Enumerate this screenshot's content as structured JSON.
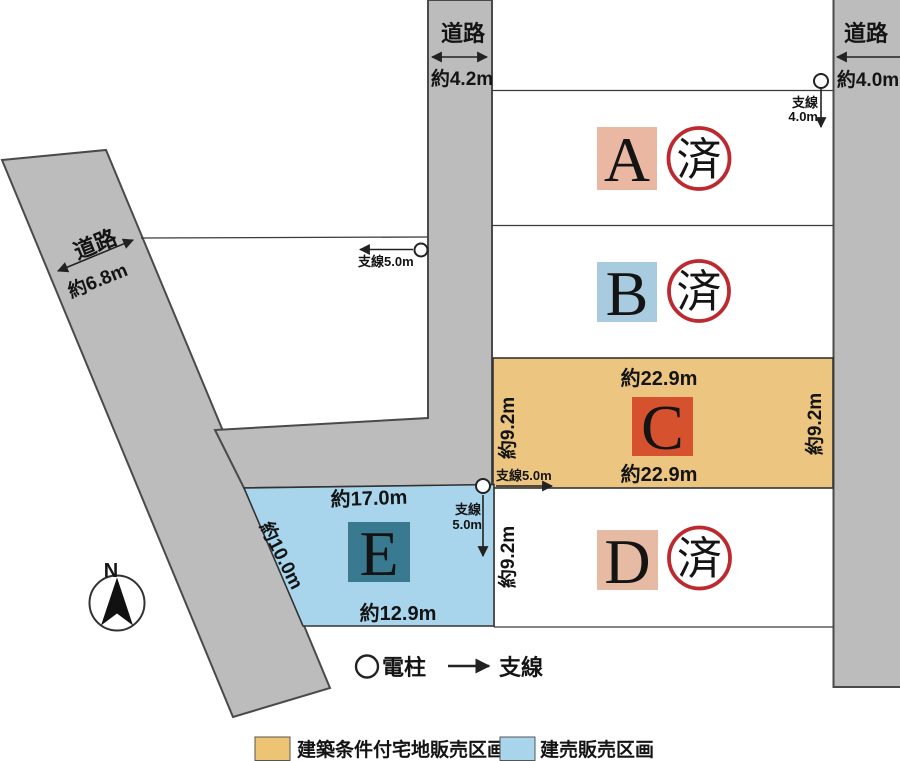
{
  "roads": {
    "top": {
      "name": "道路",
      "width": "約4.2m"
    },
    "right": {
      "name": "道路",
      "width": "約4.0m"
    },
    "left": {
      "name": "道路",
      "width": "約6.8m"
    }
  },
  "plots": {
    "a": {
      "id": "A",
      "stamp": "済"
    },
    "b": {
      "id": "B",
      "stamp": "済"
    },
    "c": {
      "id": "C",
      "top": "約22.9m",
      "bottom": "約22.9m",
      "left": "約9.2m",
      "right": "約9.2m"
    },
    "d": {
      "id": "D",
      "stamp": "済",
      "left": "約9.2m"
    },
    "e": {
      "id": "E",
      "top": "約17.0m",
      "bottom": "約12.9m",
      "left": "約10.0m"
    }
  },
  "wires": {
    "left_pole": {
      "label": "支線5.0m"
    },
    "right_pole": {
      "line1": "支線",
      "line2": "4.0m"
    },
    "c_wire": {
      "label": "支線5.0m"
    },
    "e_pole": {
      "line1": "支線",
      "line2": "5.0m"
    }
  },
  "compass": {
    "north": "N"
  },
  "symbols": {
    "pole": "電柱",
    "wire": "支線"
  },
  "legend": [
    {
      "label": "建築条件付宅地販売区画",
      "color": "#edc473"
    },
    {
      "label": "建売販売区画",
      "color": "#a8d5ec"
    }
  ],
  "colors": {
    "road": "#bcbcbc",
    "c_fill": "#ecc681",
    "e_fill": "#a8d5ec",
    "sq_a": "#e9b7a2",
    "sq_b": "#a9cbdf",
    "sq_c": "#d6512d",
    "sq_d": "#e7baa4",
    "sq_e": "#3a7a91",
    "stamp": "#bc2a30"
  }
}
